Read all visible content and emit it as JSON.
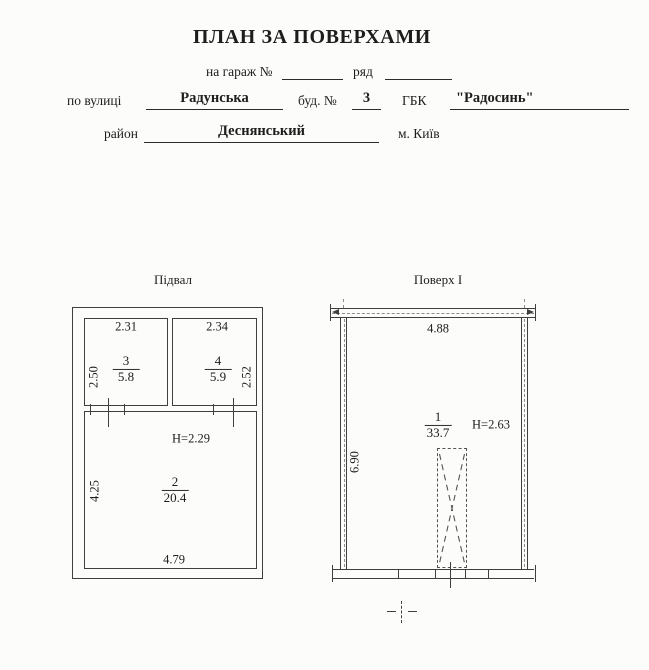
{
  "header": {
    "title": "ПЛАН ЗА ПОВЕРХАМИ",
    "garage_label": "на гараж №",
    "garage_value": "",
    "row_label": "ряд",
    "row_value": "",
    "street_label": "по вулиці",
    "street_value": "Радунська",
    "building_label": "буд. №",
    "building_value": "3",
    "coop_label": "ГБК",
    "coop_value": "\"Радосинь\"",
    "district_label": "район",
    "district_value": "Деснянський",
    "city_label": "м. Київ"
  },
  "basement": {
    "title": "Підвал",
    "height_label": "Н=2.29",
    "dim_top_left": "2.31",
    "dim_top_right": "2.34",
    "dim_left_upper": "2.50",
    "dim_right_upper": "2.52",
    "dim_left_lower": "4.25",
    "dim_bottom": "4.79",
    "room_left": {
      "number": "3",
      "area": "5.8"
    },
    "room_right": {
      "number": "4",
      "area": "5.9"
    },
    "room_main": {
      "number": "2",
      "area": "20.4"
    }
  },
  "floor1": {
    "title": "Поверх I",
    "height_label": "Н=2.63",
    "dim_top": "4.88",
    "dim_left": "6.90",
    "room": {
      "number": "1",
      "area": "33.7"
    }
  },
  "colors": {
    "ink": "#1d1d1b",
    "line": "#3f3f3c",
    "paper": "#fcfcfa"
  }
}
